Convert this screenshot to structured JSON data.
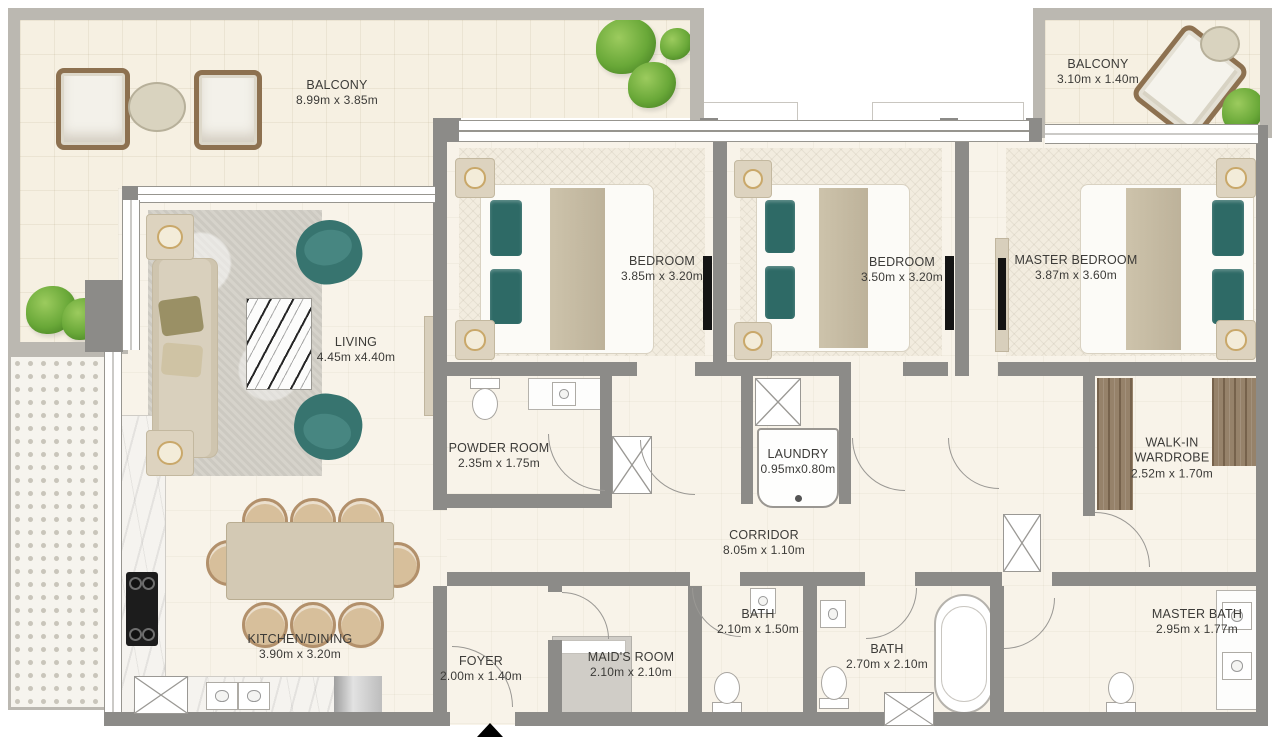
{
  "meta": {
    "title": "Apartment floor plan",
    "plan_type": "3-bedroom apartment with balconies"
  },
  "colors": {
    "wall_interior": "#8c8b88",
    "wall_exterior": "#bbb8b1",
    "floor": "#f8f3e9",
    "accent_teal": "#37746f",
    "wood": "#96826a",
    "label_text": "#3c3b38"
  },
  "rooms": {
    "balcony_main": {
      "name": "BALCONY",
      "dims": "8.99m x 3.85m"
    },
    "balcony_master": {
      "name": "BALCONY",
      "dims": "3.10m x 1.40m"
    },
    "living": {
      "name": "LIVING",
      "dims": "4.45m x4.40m"
    },
    "bedroom_1": {
      "name": "BEDROOM",
      "dims": "3.85m x 3.20m"
    },
    "bedroom_2": {
      "name": "BEDROOM",
      "dims": "3.50m x 3.20m"
    },
    "master_bedroom": {
      "name": "MASTER BEDROOM",
      "dims": "3.87m x 3.60m"
    },
    "powder_room": {
      "name": "POWDER ROOM",
      "dims": "2.35m x 1.75m"
    },
    "laundry": {
      "name": "LAUNDRY",
      "dims": "0.95mx0.80m"
    },
    "corridor": {
      "name": "CORRIDOR",
      "dims": "8.05m x 1.10m"
    },
    "walk_in_wardrobe": {
      "name": "WALK-IN WARDROBE",
      "dims": "2.52m x 1.70m"
    },
    "kitchen_dining": {
      "name": "KITCHEN/DINING",
      "dims": "3.90m x 3.20m"
    },
    "foyer": {
      "name": "FOYER",
      "dims": "2.00m x 1.40m"
    },
    "maids_room": {
      "name": "MAID'S ROOM",
      "dims": "2.10m x 2.10m"
    },
    "bath_1": {
      "name": "BATH",
      "dims": "2.10m x 1.50m"
    },
    "bath_2": {
      "name": "BATH",
      "dims": "2.70m x 2.10m"
    },
    "master_bath": {
      "name": "MASTER BATH",
      "dims": "2.95m x 1.77m"
    }
  }
}
